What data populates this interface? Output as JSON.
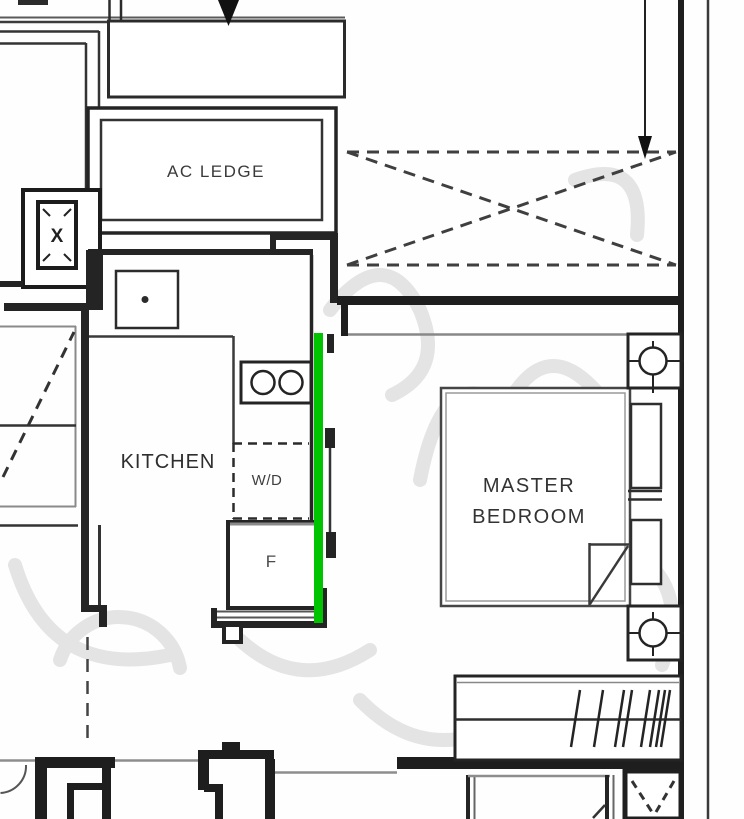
{
  "labels": {
    "ac_ledge": "AC LEDGE",
    "kitchen": "KITCHEN",
    "washer_dryer": "W/D",
    "fridge": "F",
    "master_bedroom_line1": "MASTER",
    "master_bedroom_line2": "BEDROOM",
    "shaft_x": "X"
  },
  "colors": {
    "wall_black": "#1e1e1e",
    "line_gray": "#8d8d8d",
    "text_gray": "#3a3a3a",
    "highlight_green": "#00c400",
    "watermark_gray": "#e4e4e4",
    "background": "#fefefe"
  }
}
